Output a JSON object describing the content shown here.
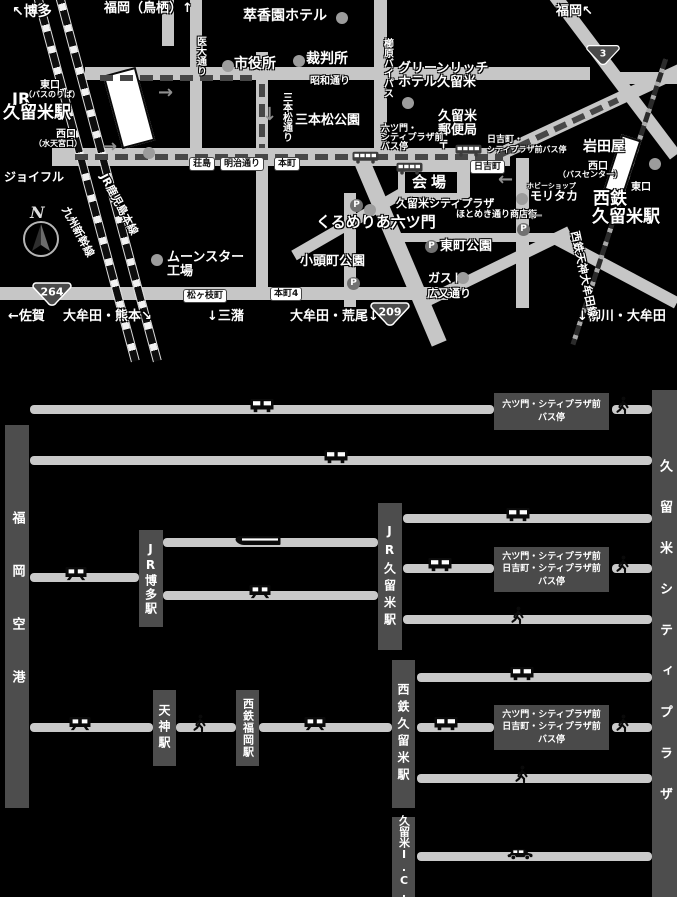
{
  "map": {
    "venue": {
      "title": "会場",
      "subtitle": "久留米シティプラザ"
    },
    "compass": {
      "letter": "N"
    },
    "labels": [
      {
        "name": "to-hakata",
        "text": "↖博多",
        "x": 12,
        "y": 5,
        "fs": 14
      },
      {
        "name": "to-fukuoka-tosu",
        "text": "福岡（鳥栖）↑",
        "x": 104,
        "y": 2,
        "fs": 13
      },
      {
        "name": "suikoen-hotel",
        "text": "萃香園ホテル",
        "x": 243,
        "y": 9,
        "fs": 14
      },
      {
        "name": "to-fukuoka",
        "text": "福岡↖",
        "x": 556,
        "y": 5,
        "fs": 13
      },
      {
        "name": "idai-dori",
        "text": "医大通り",
        "x": 194,
        "y": 36,
        "fs": 10,
        "v": true
      },
      {
        "name": "city-hall",
        "text": "市役所",
        "x": 234,
        "y": 57,
        "fs": 14
      },
      {
        "name": "courthouse",
        "text": "裁判所",
        "x": 306,
        "y": 52,
        "fs": 14
      },
      {
        "name": "jr-east-exit",
        "text": "東口",
        "x": 40,
        "y": 81,
        "fs": 10
      },
      {
        "name": "jr-east-exit-note",
        "text": "（バスのりば）",
        "x": 24,
        "y": 91,
        "fs": 8
      },
      {
        "name": "jr-prefix",
        "text": "JR",
        "x": 12,
        "y": 91,
        "fs": 16
      },
      {
        "name": "jr-kurume-station-label",
        "text": "久留米駅",
        "x": 3,
        "y": 105,
        "fs": 17
      },
      {
        "name": "jr-west-exit",
        "text": "西口",
        "x": 56,
        "y": 130,
        "fs": 10
      },
      {
        "name": "jr-west-exit-note",
        "text": "（水天宮口）",
        "x": 34,
        "y": 140,
        "fs": 8
      },
      {
        "name": "joyful",
        "text": "ジョイフル",
        "x": 4,
        "y": 171,
        "fs": 12
      },
      {
        "name": "showa-dori",
        "text": "昭和通り",
        "x": 310,
        "y": 77,
        "fs": 10
      },
      {
        "name": "sanbonmatsu-dori",
        "text": "三本松通り",
        "x": 280,
        "y": 92,
        "fs": 10,
        "v": true
      },
      {
        "name": "sanbonmatsu-park",
        "text": "三本松公園",
        "x": 295,
        "y": 114,
        "fs": 13
      },
      {
        "name": "kushihara-bypass",
        "text": "櫛原バイパス",
        "x": 381,
        "y": 38,
        "fs": 10,
        "v": true
      },
      {
        "name": "green-rich-hotel-1",
        "text": "グリーンリッチ",
        "x": 398,
        "y": 62,
        "fs": 13
      },
      {
        "name": "green-rich-hotel-2",
        "text": "ホテル久留米",
        "x": 398,
        "y": 76,
        "fs": 13
      },
      {
        "name": "kurume-post-office-1",
        "text": "久留米",
        "x": 438,
        "y": 110,
        "fs": 13
      },
      {
        "name": "kurume-post-office-2",
        "text": "郵便局",
        "x": 438,
        "y": 124,
        "fs": 13
      },
      {
        "name": "kurume-post-office-mark",
        "text": "〒",
        "x": 438,
        "y": 139,
        "fs": 11
      },
      {
        "name": "mutsumon-busstop-1",
        "text": "六ツ門・",
        "x": 381,
        "y": 125,
        "fs": 9
      },
      {
        "name": "mutsumon-busstop-2",
        "text": "シティプラザ前",
        "x": 381,
        "y": 134,
        "fs": 9
      },
      {
        "name": "mutsumon-busstop-3",
        "text": "バス停",
        "x": 381,
        "y": 143,
        "fs": 9
      },
      {
        "name": "hiyoshi-busstop-1",
        "text": "日吉町・",
        "x": 487,
        "y": 136,
        "fs": 9
      },
      {
        "name": "hiyoshi-busstop-2",
        "text": "シティプラザ前バス停",
        "x": 487,
        "y": 146,
        "fs": 8
      },
      {
        "name": "nishitetsu-west-exit",
        "text": "西口",
        "x": 588,
        "y": 162,
        "fs": 10
      },
      {
        "name": "nishitetsu-west-exit-note",
        "text": "（バスセンター）",
        "x": 558,
        "y": 171,
        "fs": 8
      },
      {
        "name": "nishitetsu-east-exit",
        "text": "東口",
        "x": 631,
        "y": 183,
        "fs": 10
      },
      {
        "name": "nishitetsu-label-1",
        "text": "西鉄",
        "x": 593,
        "y": 191,
        "fs": 17
      },
      {
        "name": "nishitetsu-label-2",
        "text": "久留米駅",
        "x": 592,
        "y": 209,
        "fs": 17
      },
      {
        "name": "iwataya",
        "text": "岩田屋",
        "x": 583,
        "y": 140,
        "fs": 14
      },
      {
        "name": "hobby-shop",
        "text": "ホビーショップ",
        "x": 527,
        "y": 183,
        "fs": 7
      },
      {
        "name": "moritaka",
        "text": "モリタカ",
        "x": 530,
        "y": 190,
        "fs": 12
      },
      {
        "name": "hotomeki-street",
        "text": "ほとめき通り商店街",
        "x": 456,
        "y": 211,
        "fs": 9
      },
      {
        "name": "kurumeria-mutsumon",
        "text": "くるめりあ六ツ門",
        "x": 316,
        "y": 215,
        "fs": 15
      },
      {
        "name": "higashimachi-park",
        "text": "東町公園",
        "x": 440,
        "y": 240,
        "fs": 13
      },
      {
        "name": "gusto",
        "text": "ガスト",
        "x": 428,
        "y": 272,
        "fs": 12
      },
      {
        "name": "hiromata-dori",
        "text": "広又通り",
        "x": 427,
        "y": 288,
        "fs": 11
      },
      {
        "name": "kogashiramachi-park",
        "text": "小頭町公園",
        "x": 300,
        "y": 255,
        "fs": 13
      },
      {
        "name": "moonstar-factory-1",
        "text": "ムーンスター",
        "x": 167,
        "y": 251,
        "fs": 13
      },
      {
        "name": "moonstar-factory-2",
        "text": "工場",
        "x": 167,
        "y": 265,
        "fs": 13
      },
      {
        "name": "to-saga",
        "text": "←佐賀",
        "x": 8,
        "y": 310,
        "fs": 13
      },
      {
        "name": "to-omuta-kumamoto",
        "text": "大牟田・熊本↘",
        "x": 63,
        "y": 310,
        "fs": 13
      },
      {
        "name": "to-mizuma",
        "text": "↓三潴",
        "x": 207,
        "y": 310,
        "fs": 13
      },
      {
        "name": "to-omuta-arao",
        "text": "大牟田・荒尾↓",
        "x": 290,
        "y": 310,
        "fs": 13
      },
      {
        "name": "to-yanagawa-omuta",
        "text": "↓柳川・大牟田",
        "x": 577,
        "y": 310,
        "fs": 13
      },
      {
        "name": "jr-kagoshima-line",
        "text": "JR鹿児島本線",
        "x": 108,
        "y": 172,
        "fs": 11,
        "rot": 62
      },
      {
        "name": "kyushu-shinkansen",
        "text": "九州新幹線",
        "x": 70,
        "y": 205,
        "fs": 11,
        "rot": 62
      },
      {
        "name": "nishitetsu-tenjin-omuta-line",
        "text": "西鉄天神大牟田線",
        "x": 580,
        "y": 230,
        "fs": 11,
        "rot": 78
      }
    ],
    "signs": [
      {
        "name": "road-sign-shojima",
        "text": "荘島",
        "x": 190,
        "y": 158
      },
      {
        "name": "road-sign-meiji-dori",
        "text": "明治通り",
        "x": 221,
        "y": 158
      },
      {
        "name": "road-sign-honmachi",
        "text": "本町",
        "x": 275,
        "y": 158
      },
      {
        "name": "road-sign-hiyoshimachi",
        "text": "日吉町",
        "x": 471,
        "y": 161
      },
      {
        "name": "road-sign-honmachi4",
        "text": "本町4",
        "x": 271,
        "y": 288
      },
      {
        "name": "road-sign-matsugaedamachi",
        "text": "松ヶ枝町",
        "x": 184,
        "y": 290
      }
    ],
    "shields": [
      {
        "name": "route-3-shield",
        "num": "3",
        "x": 586,
        "y": 43,
        "w": 34
      },
      {
        "name": "route-264-shield",
        "num": "264",
        "x": 32,
        "y": 282,
        "w": 40
      },
      {
        "name": "route-209-shield",
        "num": "209",
        "x": 370,
        "y": 302,
        "w": 40
      }
    ],
    "parkings": [
      [
        350,
        199
      ],
      [
        347,
        277
      ],
      [
        517,
        223
      ],
      [
        425,
        240
      ]
    ],
    "dots": [
      [
        336,
        12
      ],
      [
        222,
        60
      ],
      [
        293,
        55
      ],
      [
        402,
        97
      ],
      [
        143,
        147
      ],
      [
        516,
        193
      ],
      [
        649,
        158
      ],
      [
        457,
        272
      ],
      [
        151,
        254
      ],
      [
        364,
        204
      ]
    ],
    "bus_pictos": [
      [
        352,
        149
      ],
      [
        396,
        160
      ],
      [
        455,
        142
      ]
    ],
    "arrows": [
      {
        "dir": "right",
        "x": 158,
        "y": 84
      },
      {
        "dir": "right",
        "x": 102,
        "y": 138
      },
      {
        "dir": "down",
        "x": 262,
        "y": 106
      },
      {
        "dir": "left",
        "x": 528,
        "y": 207
      },
      {
        "dir": "left",
        "x": 498,
        "y": 171
      }
    ]
  },
  "diagram": {
    "nodes": [
      {
        "name": "node-fukuoka-airport",
        "label": "福岡空港",
        "x": 5,
        "y": 425,
        "w": 24,
        "h": 383,
        "fs": 13,
        "ls": 40
      },
      {
        "name": "node-jr-hakata-station",
        "label": "JR博多駅",
        "x": 139,
        "y": 530,
        "w": 24,
        "h": 97,
        "fs": 12,
        "ls": 2
      },
      {
        "name": "node-jr-kurume-station",
        "label": "JR久留米駅",
        "x": 378,
        "y": 503,
        "w": 24,
        "h": 147,
        "fs": 12,
        "ls": 5
      },
      {
        "name": "node-tenjin-station",
        "label": "天神駅",
        "x": 153,
        "y": 690,
        "w": 23,
        "h": 76,
        "fs": 12,
        "ls": 4
      },
      {
        "name": "node-nishitetsu-fukuoka-station",
        "label": "西鉄福岡駅",
        "x": 236,
        "y": 690,
        "w": 23,
        "h": 76,
        "fs": 11,
        "ls": 1
      },
      {
        "name": "node-nishitetsu-kurume-station",
        "label": "西鉄久留米駅",
        "x": 392,
        "y": 660,
        "w": 23,
        "h": 148,
        "fs": 12,
        "ls": 5
      },
      {
        "name": "node-kurume-ic",
        "label": "久留米I.C.",
        "x": 392,
        "y": 817,
        "w": 23,
        "h": 80,
        "fs": 11,
        "ls": 0
      },
      {
        "name": "node-kurume-city-plaza",
        "label": "久留米シティプラザ",
        "x": 652,
        "y": 390,
        "w": 25,
        "h": 507,
        "fs": 13,
        "ls": 28
      }
    ],
    "stop_boxes": [
      {
        "name": "busstop-box-1",
        "lines": [
          "六ツ門・シティプラザ前",
          "バス停"
        ],
        "x": 494,
        "y": 393,
        "w": 115,
        "h": 37
      },
      {
        "name": "busstop-box-2",
        "lines": [
          "六ツ門・シティプラザ前",
          "日吉町・シティプラザ前",
          "バス停"
        ],
        "x": 494,
        "y": 547,
        "w": 115,
        "h": 45
      },
      {
        "name": "busstop-box-3",
        "lines": [
          "六ツ門・シティプラザ前",
          "日吉町・シティプラザ前",
          "バス停"
        ],
        "x": 494,
        "y": 705,
        "w": 115,
        "h": 45
      }
    ],
    "lines": [
      [
        30,
        494,
        409
      ],
      [
        612,
        652,
        409
      ],
      [
        30,
        652,
        460
      ],
      [
        163,
        378,
        542
      ],
      [
        30,
        139,
        577
      ],
      [
        163,
        378,
        595
      ],
      [
        403,
        652,
        518
      ],
      [
        403,
        494,
        568
      ],
      [
        612,
        652,
        568
      ],
      [
        403,
        652,
        619
      ],
      [
        30,
        153,
        727
      ],
      [
        176,
        236,
        727
      ],
      [
        259,
        392,
        727
      ],
      [
        417,
        652,
        677
      ],
      [
        417,
        494,
        727
      ],
      [
        612,
        652,
        727
      ],
      [
        417,
        652,
        778
      ],
      [
        417,
        652,
        856
      ]
    ],
    "icons": [
      {
        "t": "bus",
        "x": 262,
        "y": 409
      },
      {
        "t": "walk",
        "x": 623,
        "y": 409
      },
      {
        "t": "bus",
        "x": 336,
        "y": 460
      },
      {
        "t": "shink",
        "x": 258,
        "y": 542
      },
      {
        "t": "train",
        "x": 76,
        "y": 577
      },
      {
        "t": "train",
        "x": 260,
        "y": 595
      },
      {
        "t": "bus",
        "x": 518,
        "y": 518
      },
      {
        "t": "bus",
        "x": 440,
        "y": 568
      },
      {
        "t": "walk",
        "x": 623,
        "y": 568
      },
      {
        "t": "walk",
        "x": 518,
        "y": 619
      },
      {
        "t": "train",
        "x": 80,
        "y": 727
      },
      {
        "t": "walk",
        "x": 200,
        "y": 727
      },
      {
        "t": "train",
        "x": 315,
        "y": 727
      },
      {
        "t": "bus",
        "x": 522,
        "y": 677
      },
      {
        "t": "bus",
        "x": 446,
        "y": 727
      },
      {
        "t": "walk",
        "x": 623,
        "y": 727
      },
      {
        "t": "walk",
        "x": 522,
        "y": 778
      },
      {
        "t": "car",
        "x": 520,
        "y": 856
      }
    ]
  }
}
